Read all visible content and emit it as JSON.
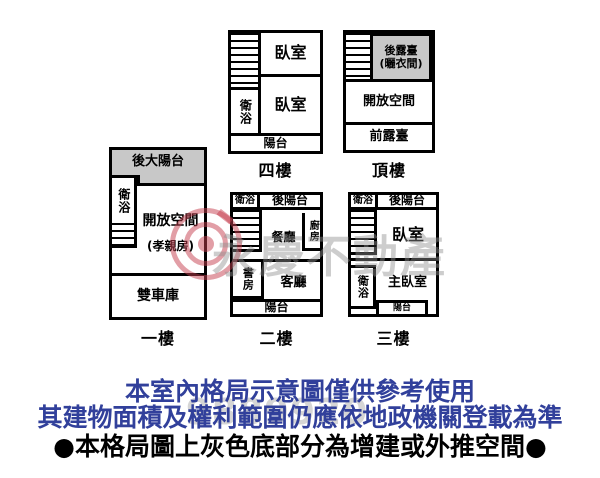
{
  "colors": {
    "wall": "#000000",
    "gray_fill": "#c8c8c8",
    "disclaimer_blue": "#31409b",
    "disclaimer_black": "#000000",
    "watermark_red": "rgba(198,62,78,0.5)",
    "watermark_gray": "rgba(145,145,145,0.45)"
  },
  "plans": {
    "floor4": {
      "label": "四樓",
      "rooms": {
        "bedroom_top": "臥室",
        "bedroom_bottom": "臥室",
        "bathroom": "衛浴",
        "balcony": "陽台"
      }
    },
    "roof": {
      "label": "頂樓",
      "rooms": {
        "rear_terrace": "後露臺",
        "rear_terrace_sub": "(曬衣間)",
        "open_space": "開放空間",
        "front_terrace": "前露臺"
      }
    },
    "floor1": {
      "label": "一樓",
      "rooms": {
        "rear_balcony": "後大陽台",
        "bathroom": "衛浴",
        "open_space": "開放空間",
        "open_space_sub": "(孝親房)",
        "garage": "雙車庫"
      }
    },
    "floor2": {
      "label": "二樓",
      "rooms": {
        "bathroom": "衛浴",
        "rear_balcony": "後陽台",
        "kitchen": "廚房",
        "dining": "餐廳",
        "study": "書房",
        "living": "客廳",
        "balcony": "陽台"
      }
    },
    "floor3": {
      "label": "三樓",
      "rooms": {
        "bathroom_top": "衛浴",
        "rear_balcony": "後陽台",
        "bedroom": "臥室",
        "bathroom_bottom": "衛浴",
        "master_bedroom": "主臥室",
        "balcony": "陽台"
      }
    }
  },
  "watermark": {
    "brand_text": "永慶不動產",
    "serial_number": "9889920"
  },
  "disclaimer": {
    "line1": "本室內格局示意圖僅供參考使用",
    "line2": "其建物面積及權利範圍仍應依地政機關登載為準",
    "line3": "●本格局圖上灰色底部分為增建或外推空間●"
  }
}
